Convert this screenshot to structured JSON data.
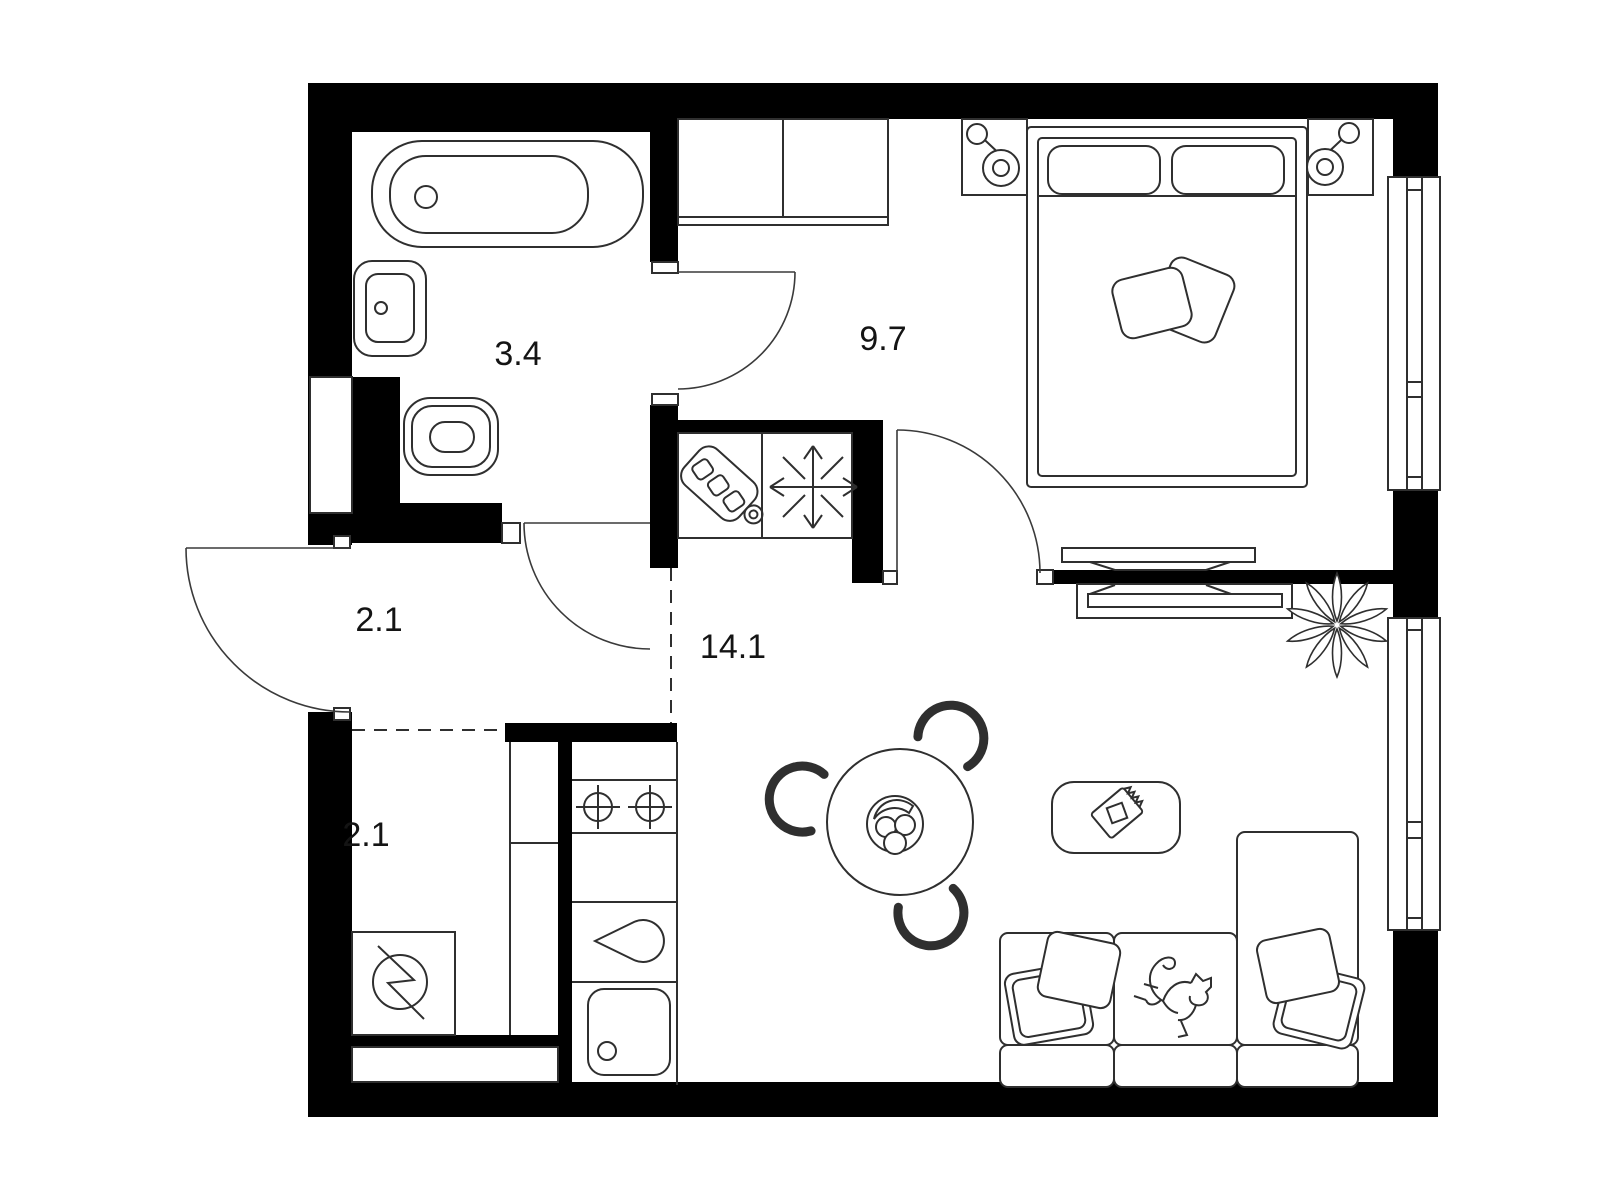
{
  "document": {
    "type": "apartment-floor-plan",
    "units": "square-meters"
  },
  "colors": {
    "wall": "#000000",
    "line": "#2f2f2f",
    "background": "#ffffff"
  },
  "rooms": [
    {
      "name": "bathroom",
      "area_label": "3.4"
    },
    {
      "name": "bedroom",
      "area_label": "9.7"
    },
    {
      "name": "hallway",
      "area_label": "2.1"
    },
    {
      "name": "living-room-kitchen",
      "area_label": "14.1"
    },
    {
      "name": "storage",
      "area_label": "2.1"
    }
  ],
  "furniture_icons": [
    "bathtub-icon",
    "washbasin-icon",
    "toilet-icon",
    "plumbing-shaft-icon",
    "washing-machine-icon",
    "storage-shelf-icon",
    "hob-icon",
    "kitchen-faucet-icon",
    "kitchen-sink-icon",
    "fridge-cutting-board-icon",
    "freezer-snowflake-icon",
    "wardrobe-icon",
    "double-bed-icon",
    "bed-pillow-icon",
    "throw-pillow-icon",
    "nightstand-icon",
    "table-lamp-icon",
    "tv-icon",
    "tv-console-icon",
    "window-icon",
    "door-swing-icon",
    "dining-table-icon",
    "dining-chair-icon",
    "fruit-bowl-icon",
    "coffee-table-icon",
    "notebook-icon",
    "corner-sofa-icon",
    "sofa-pillow-icon",
    "cat-icon",
    "plant-icon"
  ]
}
